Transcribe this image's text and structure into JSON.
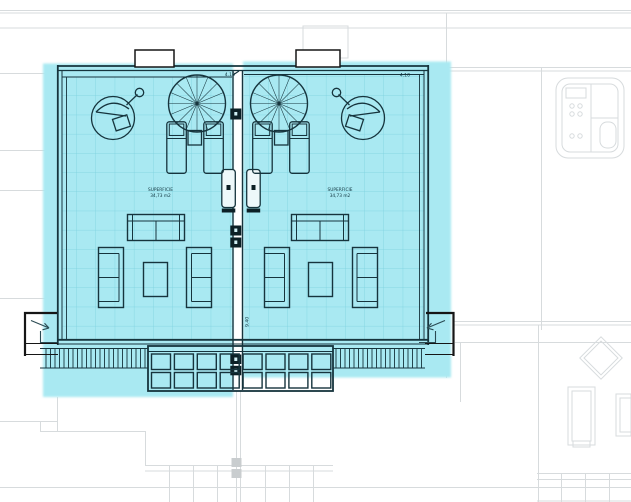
{
  "plan": {
    "title": "roof-terrace-floor-plan",
    "units": [
      {
        "id": "left-terrace",
        "area_label": "SUPERFICIE",
        "area_value": "34,73 m2",
        "width_dim": "4.10"
      },
      {
        "id": "right-terrace",
        "area_label": "SUPERFICIE",
        "area_value": "34,73 m2",
        "width_dim": "4.10"
      }
    ],
    "depth_dim": "9.40",
    "colors": {
      "highlight": "#a9e9f2",
      "tile_grid": "#7ad0de",
      "wall_line": "#16343d",
      "outside_line": "#161616",
      "background_line": "#d7dbdd"
    },
    "symbols": [
      "hanging-chair-icon",
      "parasol-icon",
      "sun-lounger-icon",
      "side-table-icon",
      "sofa-icon",
      "coffee-table-icon",
      "railing",
      "pergola-grid",
      "entry-arrow-icon",
      "jacuzzi-icon",
      "party-wall-column",
      "door-panel"
    ]
  }
}
